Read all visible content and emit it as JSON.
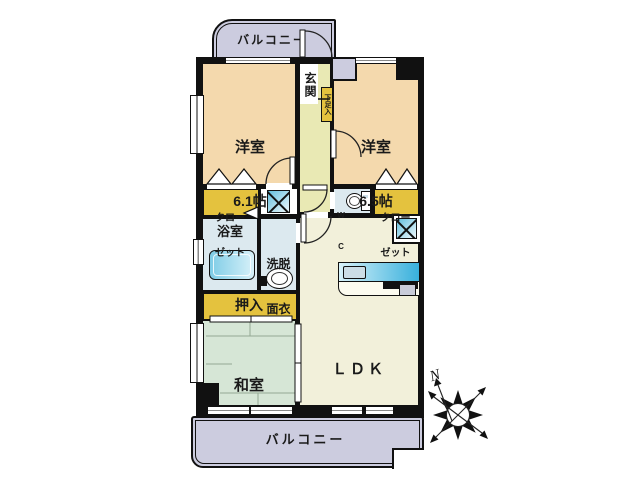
{
  "colors": {
    "wall": "#111111",
    "western_room": "#f4d9ad",
    "entrance_hall": "#e9e9b4",
    "ldk": "#f2f0da",
    "japanese_room": "#d6e6d6",
    "balcony": "#ccccdf",
    "closet": "#e4c23e",
    "sanitary": "#dce9ef",
    "fixture_blue": "#45b4dc"
  },
  "rooms": {
    "balcony_top": {
      "label": "バルコニー"
    },
    "western_room_1": {
      "name": "洋室",
      "size": "6.1帖"
    },
    "entrance": {
      "label": "玄関"
    },
    "shoe_cabinet": {
      "label": "下足入"
    },
    "western_room_2": {
      "name": "洋室",
      "size": "6.5帖"
    },
    "closet_left": {
      "line1": "クロー",
      "line2": "ゼット"
    },
    "closet_right": {
      "line1": "クロー",
      "line2": "ゼット"
    },
    "toilet": {
      "line1": "W",
      "line2": "C"
    },
    "bathroom": {
      "label": "浴室"
    },
    "washroom": {
      "line1": "洗脱",
      "line2": "面衣"
    },
    "oshiire": {
      "label": "押入"
    },
    "japanese_room": {
      "name": "和室",
      "size": "6帖"
    },
    "ldk": {
      "name": "ＬＤＫ",
      "size": "14.9帖"
    },
    "balcony_bottom": {
      "label": "バルコニー"
    }
  },
  "compass": {
    "north_label": "N"
  }
}
